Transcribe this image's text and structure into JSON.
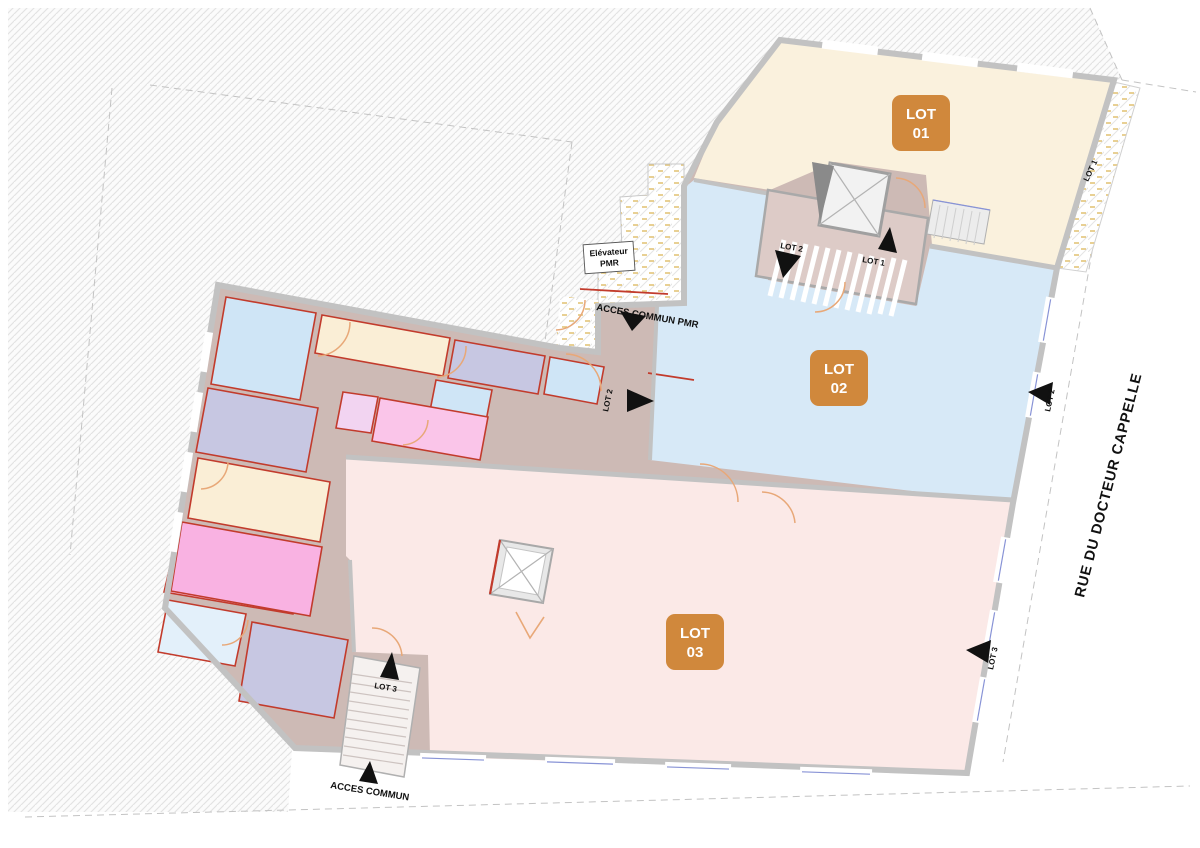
{
  "street": {
    "name": "RUE DU DOCTEUR CAPPELLE"
  },
  "badges": [
    {
      "id": "lot-01",
      "line1": "LOT",
      "line2": "01"
    },
    {
      "id": "lot-02",
      "line1": "LOT",
      "line2": "02"
    },
    {
      "id": "lot-03",
      "line1": "LOT",
      "line2": "03"
    }
  ],
  "labels": {
    "elevator_line1": "Elévateur",
    "elevator_line2": "PMR",
    "acces_commun_pmr": "ACCES COMMUN PMR",
    "acces_commun": "ACCES COMMUN",
    "entry_stair_lot2": "LOT 2",
    "entry_stair_lot1": "LOT 1",
    "entry_mid_lot2": "LOT 2",
    "entry_right_lot2": "LOT 2",
    "entry_right_lot3": "LOT 3",
    "entry_stair3_lot3": "LOT 3",
    "terrace_lot1": "LOT 1"
  },
  "colors": {
    "lot1_fill": "#faf1dd",
    "lot2_fill": "#d7e9f7",
    "lot3_fill": "#fbe9e7",
    "badge": "#d0883c",
    "corridor": "#cdbab5",
    "room_blue": "#cfe5f6",
    "room_blue_pale": "#e3f0fa",
    "room_lavender": "#c7c7e2",
    "room_cream": "#faeed6",
    "room_pink": "#fac5e9",
    "room_magenta": "#f9b2e2",
    "room_purple": "#f2d4f1",
    "door_orange": "#e8a878",
    "wall_red": "#c23b2c",
    "wall_gray": "#c2c2c2"
  }
}
